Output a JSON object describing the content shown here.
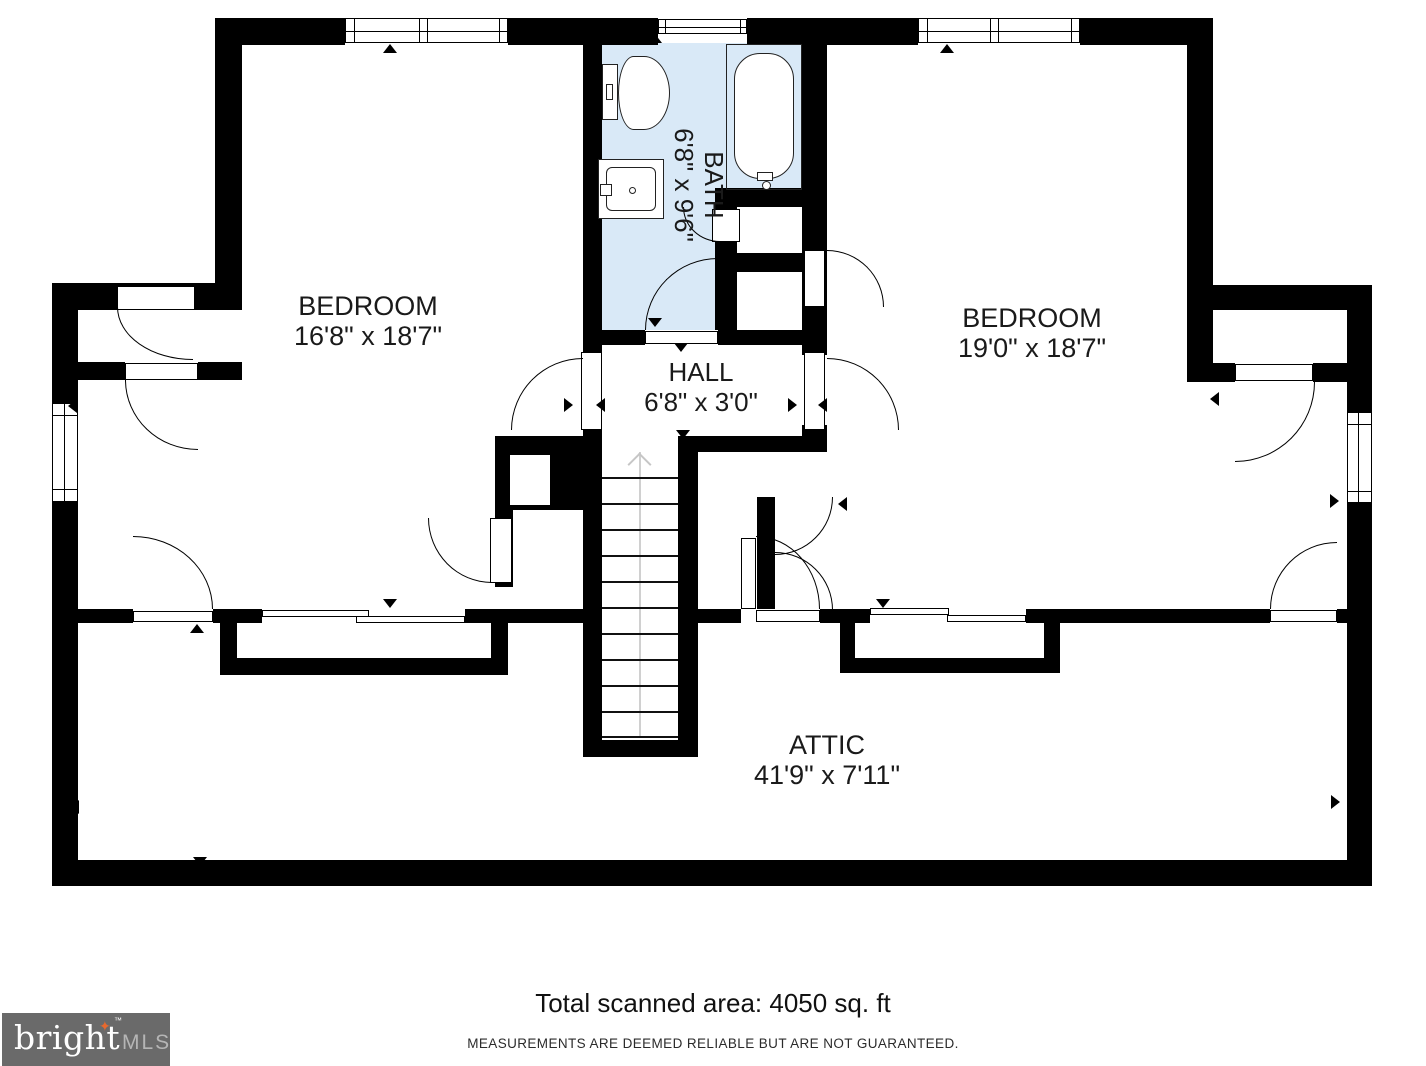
{
  "footer": {
    "area_text": "Total scanned area: 4050 sq. ft",
    "disclaimer": "MEASUREMENTS ARE DEEMED RELIABLE BUT ARE NOT GUARANTEED."
  },
  "logo": {
    "brand": "bright",
    "tm": "™",
    "suffix": "MLS"
  },
  "colors": {
    "wall": "#000000",
    "bath_fill": "#d9e9f7",
    "paper": "#ffffff",
    "logo_bg": "#6a6a6a",
    "logo_text": "#ffffff",
    "logo_suffix": "#b5b5b5",
    "logo_star": "#e8692e",
    "stair_guide": "#c9c9c9",
    "label_text": "#1a1a1a"
  },
  "rooms": [
    {
      "id": "bedroom-left",
      "name": "BEDROOM",
      "dims": "16'8\" x 18'7\"",
      "cx": 368,
      "cy": 321,
      "rotate": 0
    },
    {
      "id": "bath",
      "name": "BATH",
      "dims": "6'8\" x 9'6\"",
      "cx": 699,
      "cy": 185,
      "rotate": 90
    },
    {
      "id": "bedroom-right",
      "name": "BEDROOM",
      "dims": "19'0\" x 18'7\"",
      "cx": 1032,
      "cy": 333,
      "rotate": 0
    },
    {
      "id": "hall",
      "name": "HALL",
      "dims": "6'8\" x 3'0\"",
      "cx": 701,
      "cy": 387,
      "rotate": 0
    },
    {
      "id": "attic",
      "name": "ATTIC",
      "dims": "41'9\" x 7'11\"",
      "cx": 827,
      "cy": 760,
      "rotate": 0
    }
  ],
  "geometry": {
    "bath_fill_rect": [
      602,
      43,
      200,
      287
    ],
    "walls": [
      [
        215,
        18,
        130,
        27
      ],
      [
        508,
        18,
        150,
        27
      ],
      [
        747,
        18,
        171,
        27
      ],
      [
        1080,
        18,
        133,
        27
      ],
      [
        215,
        18,
        27,
        292
      ],
      [
        52,
        283,
        175,
        27
      ],
      [
        52,
        283,
        26,
        120
      ],
      [
        52,
        502,
        26,
        383
      ],
      [
        52,
        860,
        1320,
        26
      ],
      [
        1347,
        285,
        25,
        127
      ],
      [
        1347,
        503,
        25,
        382
      ],
      [
        1187,
        18,
        26,
        292
      ],
      [
        1187,
        285,
        185,
        25
      ],
      [
        1187,
        310,
        26,
        72
      ],
      [
        1213,
        363,
        22,
        19
      ],
      [
        1313,
        363,
        34,
        19
      ],
      [
        78,
        362,
        47,
        18
      ],
      [
        198,
        362,
        44,
        18
      ],
      [
        583,
        43,
        19,
        287
      ],
      [
        802,
        43,
        25,
        287
      ],
      [
        583,
        330,
        62,
        15
      ],
      [
        718,
        330,
        109,
        15
      ],
      [
        583,
        345,
        19,
        10
      ],
      [
        583,
        425,
        19,
        15
      ],
      [
        802,
        330,
        25,
        25
      ],
      [
        802,
        425,
        25,
        15
      ],
      [
        678,
        436,
        149,
        16
      ],
      [
        495,
        436,
        107,
        74
      ],
      [
        495,
        510,
        18,
        77
      ],
      [
        583,
        432,
        19,
        325
      ],
      [
        678,
        438,
        20,
        319
      ],
      [
        583,
        740,
        115,
        17
      ],
      [
        757,
        497,
        18,
        112
      ],
      [
        715,
        188,
        112,
        19
      ],
      [
        715,
        207,
        22,
        123
      ],
      [
        737,
        253,
        90,
        19
      ],
      [
        78,
        609,
        55,
        14
      ],
      [
        213,
        609,
        49,
        14
      ],
      [
        465,
        609,
        137,
        14
      ],
      [
        698,
        609,
        43,
        14
      ],
      [
        820,
        609,
        50,
        14
      ],
      [
        1026,
        609,
        244,
        14
      ],
      [
        1337,
        609,
        10,
        14
      ],
      [
        220,
        623,
        17,
        52
      ],
      [
        220,
        658,
        288,
        17
      ],
      [
        491,
        623,
        17,
        35
      ],
      [
        840,
        623,
        15,
        50
      ],
      [
        840,
        658,
        220,
        15
      ],
      [
        1044,
        623,
        16,
        35
      ]
    ],
    "white_rects": [
      [
        737,
        207,
        65,
        46
      ],
      [
        737,
        272,
        65,
        58
      ],
      [
        510,
        455,
        40,
        50
      ]
    ],
    "leaves": [
      [
        117,
        286,
        78,
        24
      ],
      [
        125,
        363,
        73,
        17
      ],
      [
        133,
        611,
        80,
        11
      ],
      [
        581,
        352,
        21,
        78
      ],
      [
        804,
        352,
        21,
        78
      ],
      [
        645,
        331,
        73,
        13
      ],
      [
        712,
        209,
        28,
        33
      ],
      [
        804,
        250,
        21,
        57
      ],
      [
        1235,
        364,
        78,
        17
      ],
      [
        1270,
        610,
        67,
        12
      ],
      [
        741,
        538,
        15,
        71
      ],
      [
        756,
        610,
        64,
        12
      ],
      [
        490,
        518,
        22,
        65
      ]
    ],
    "windows_h": [
      {
        "rect": [
          345,
          18,
          163,
          25
        ],
        "verts": [
          354,
          419,
          427,
          499
        ],
        "mid": true
      },
      {
        "rect": [
          918,
          18,
          162,
          25
        ],
        "verts": [
          927,
          990,
          998,
          1071
        ],
        "mid": true
      },
      {
        "rect": [
          658,
          19,
          89,
          15
        ],
        "verts": [
          665,
          740
        ],
        "mid": true
      }
    ],
    "windows_v": [
      {
        "rect": [
          52,
          403,
          26,
          99
        ],
        "hors": [
          415,
          489
        ],
        "vx": 64
      },
      {
        "rect": [
          1347,
          412,
          25,
          91
        ],
        "hors": [
          424,
          491
        ],
        "vx": 1358
      }
    ],
    "dormer_bands": [
      [
        262,
        610,
        107,
        7
      ],
      [
        356,
        616,
        109,
        7
      ],
      [
        870,
        608,
        79,
        7
      ],
      [
        947,
        615,
        79,
        7
      ]
    ],
    "doors": [
      [
        117,
        307,
        76,
        53,
        "bl"
      ],
      [
        125,
        380,
        73,
        70,
        "bl"
      ],
      [
        133,
        536,
        80,
        73,
        "tr"
      ],
      [
        511,
        358,
        72,
        72,
        "tl"
      ],
      [
        827,
        358,
        72,
        72,
        "tr"
      ],
      [
        645,
        258,
        73,
        72,
        "tl"
      ],
      [
        683,
        207,
        37,
        35,
        "bl"
      ],
      [
        827,
        250,
        57,
        57,
        "tr"
      ],
      [
        1235,
        382,
        80,
        80,
        "br"
      ],
      [
        1270,
        542,
        67,
        67,
        "tl"
      ],
      [
        756,
        536,
        64,
        73,
        "tr"
      ],
      [
        775,
        497,
        58,
        58,
        "br"
      ],
      [
        775,
        552,
        58,
        58,
        "tr"
      ],
      [
        428,
        518,
        64,
        65,
        "bl"
      ]
    ],
    "markers": {
      "up": [
        [
          383,
          44
        ],
        [
          648,
          34
        ],
        [
          940,
          44
        ],
        [
          190,
          624
        ]
      ],
      "down": [
        [
          383,
          599
        ],
        [
          876,
          599
        ],
        [
          648,
          318
        ],
        [
          674,
          343
        ],
        [
          676,
          430
        ],
        [
          193,
          857
        ]
      ],
      "left": [
        [
          68,
          399
        ],
        [
          70,
          800
        ],
        [
          838,
          497
        ],
        [
          596,
          398
        ],
        [
          818,
          398
        ],
        [
          1210,
          392
        ]
      ],
      "right": [
        [
          564,
          398
        ],
        [
          788,
          398
        ],
        [
          1330,
          494
        ],
        [
          1331,
          795
        ]
      ]
    },
    "stairs": {
      "x": 602,
      "w": 76,
      "treads_y": [
        477,
        503,
        529,
        555,
        581,
        607,
        633,
        659,
        685,
        711,
        736
      ],
      "centerline": [
        639,
        452,
        2,
        284
      ],
      "chevron": [
        631,
        456
      ]
    },
    "fixtures": {
      "toilet": {
        "tank": [
          602,
          64,
          16,
          56
        ],
        "knob": [
          606,
          84,
          7,
          16
        ],
        "bowl": [
          618,
          56,
          52,
          74
        ]
      },
      "sink": {
        "outer": [
          598,
          159,
          66,
          60
        ],
        "inner": [
          606,
          167,
          50,
          44
        ],
        "faucet": [
          600,
          184,
          12,
          12
        ],
        "drain": [
          629,
          187,
          7,
          7
        ]
      },
      "tub": {
        "outer": [
          726,
          44,
          76,
          146
        ],
        "inner": [
          734,
          53,
          60,
          126
        ],
        "spout": [
          757,
          172,
          16,
          9
        ],
        "knob": [
          762,
          181,
          9,
          9
        ]
      }
    }
  }
}
